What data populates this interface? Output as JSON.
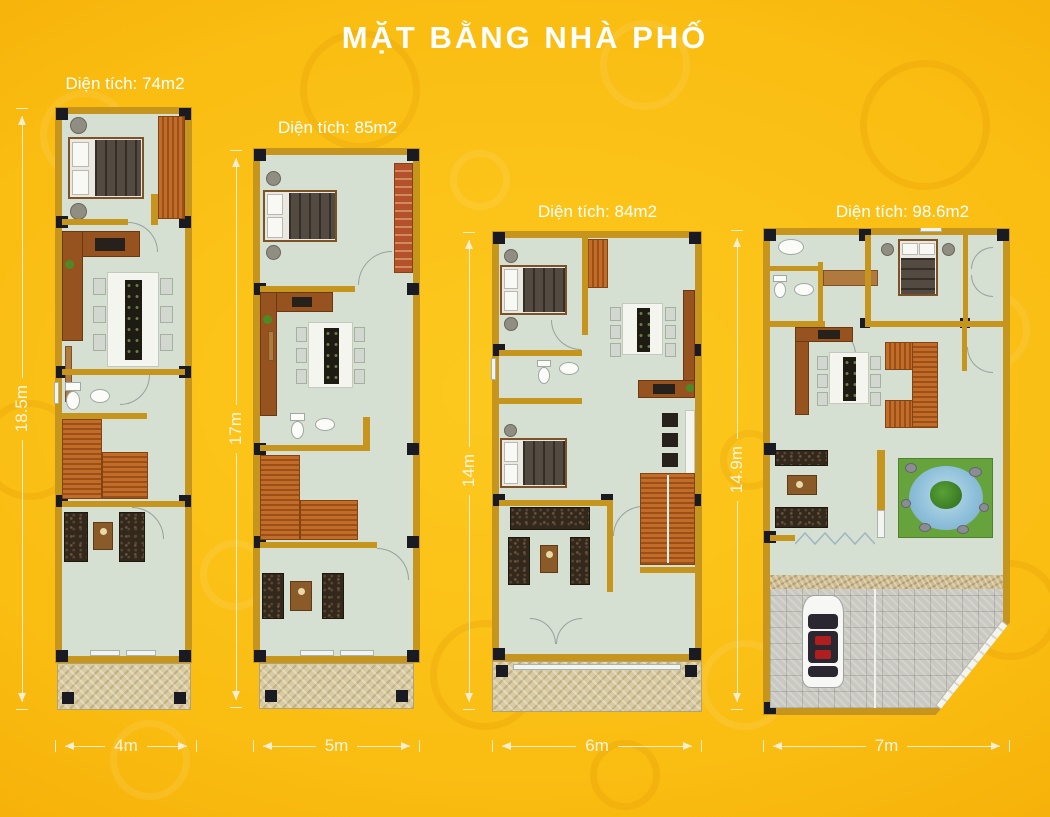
{
  "title": "MẶT BẰNG NHÀ PHỐ",
  "plans": [
    {
      "name": "plan-1",
      "area_label": "Diện tích: 74m2",
      "height_label": "18.5m",
      "width_label": "4m"
    },
    {
      "name": "plan-2",
      "area_label": "Diện tích: 85m2",
      "height_label": "17m",
      "width_label": "5m"
    },
    {
      "name": "plan-3",
      "area_label": "Diện tích: 84m2",
      "height_label": "14m",
      "width_label": "6m"
    },
    {
      "name": "plan-4",
      "area_label": "Diện tích: 98.6m2",
      "height_label": "14.9m",
      "width_label": "7m"
    }
  ],
  "colors": {
    "background": "#F8BB10",
    "wall": "#C6951E",
    "floor": "#D5DFD2",
    "column": "#1A1A22",
    "stairs": "#C26C2A",
    "text": "#FFFFFF"
  }
}
